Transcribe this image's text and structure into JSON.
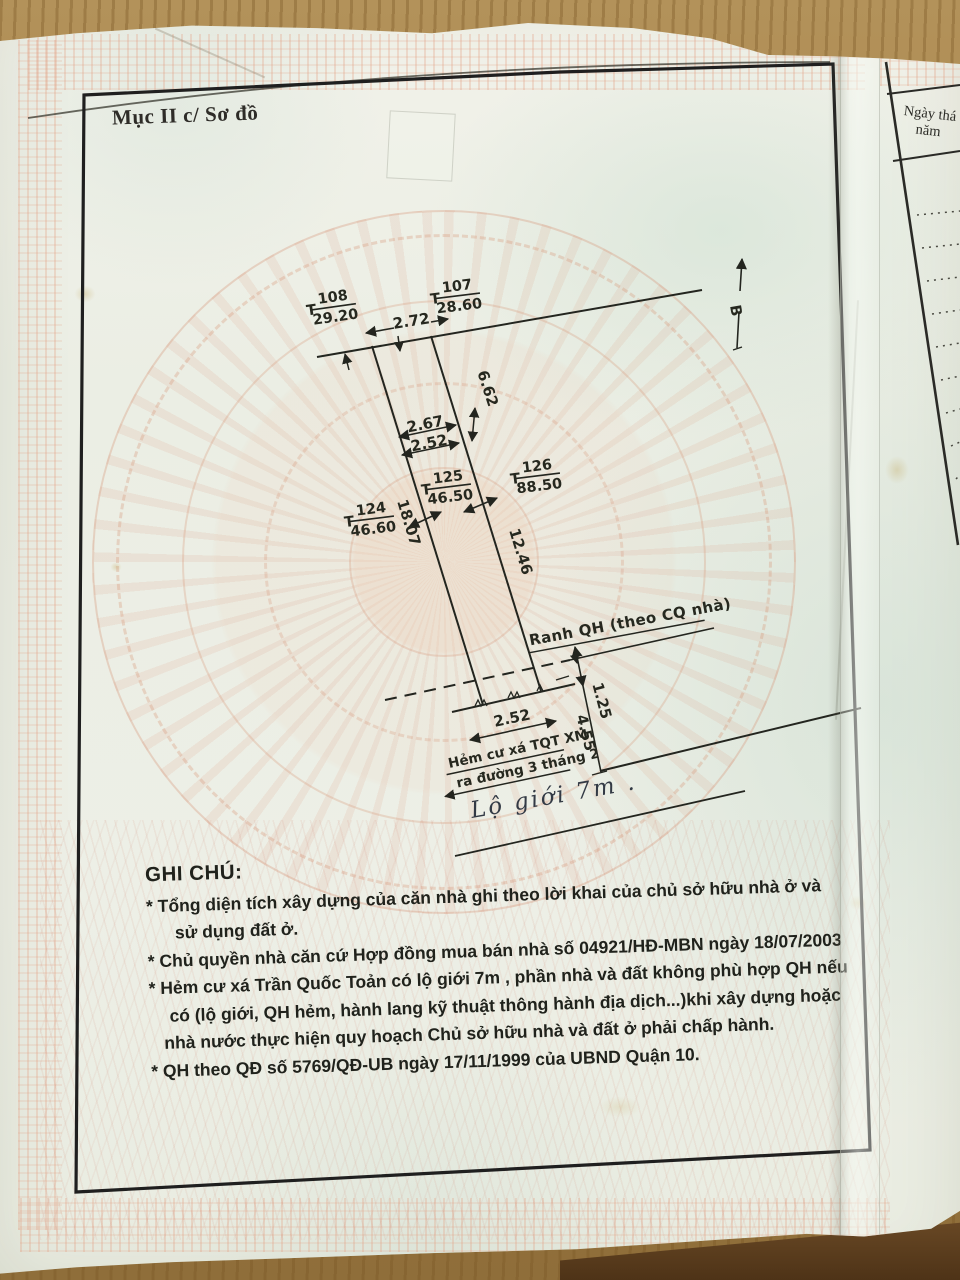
{
  "page": {
    "section_title": "Mục II c/ Sơ đồ"
  },
  "side_column": {
    "date_line1": "Ngày thá",
    "date_line2": "năm"
  },
  "diagram": {
    "north_label": "B",
    "point_prefix": "T",
    "points": [
      {
        "id": "108",
        "value": "29.20"
      },
      {
        "id": "107",
        "value": "28.60"
      },
      {
        "id": "125",
        "value": "46.50"
      },
      {
        "id": "126",
        "value": "88.50"
      },
      {
        "id": "124",
        "value": "46.60"
      }
    ],
    "dims": {
      "frontage": "2.72",
      "width_upper": "2.67",
      "width_mid": "2.52",
      "side_upper": "6.62",
      "side_left": "18.07",
      "side_right": "12.46",
      "rear_width": "2.52",
      "qh_offset": "1.25",
      "alley_offset": "4.55"
    },
    "annotations": {
      "ranh_prefix": "Ranh QH (theo ",
      "ranh_underlined": "CQ nhà",
      "ranh_suffix": ")",
      "alley_line1": "Hẻm cư xá TQT XM",
      "alley_line2": "ra đường 3 tháng 2",
      "road_note": "Lộ giới 7m ."
    }
  },
  "notes": {
    "title": "GHI CHÚ:",
    "lines": [
      "* Tổng diện tích xây dựng của căn nhà ghi theo lời khai của chủ sở hữu nhà ở và",
      "sử dụng đất ở.",
      "* Chủ quyền nhà căn cứ Hợp đồng mua bán nhà số 04921/HĐ-MBN ngày 18/07/2003",
      "* Hẻm cư xá Trần Quốc Toản có lộ giới 7m , phần nhà và đất không phù hợp QH nếu",
      "có (lộ giới, QH hẻm, hành lang kỹ thuật thông hành địa dịch...)khi xây dựng hoặc",
      "nhà nước thực hiện quy hoạch Chủ sở hữu nhà và đất ở phải chấp hành.",
      "* QH theo QĐ số 5769/QĐ-UB ngày 17/11/1999 của UBND Quận 10."
    ]
  }
}
